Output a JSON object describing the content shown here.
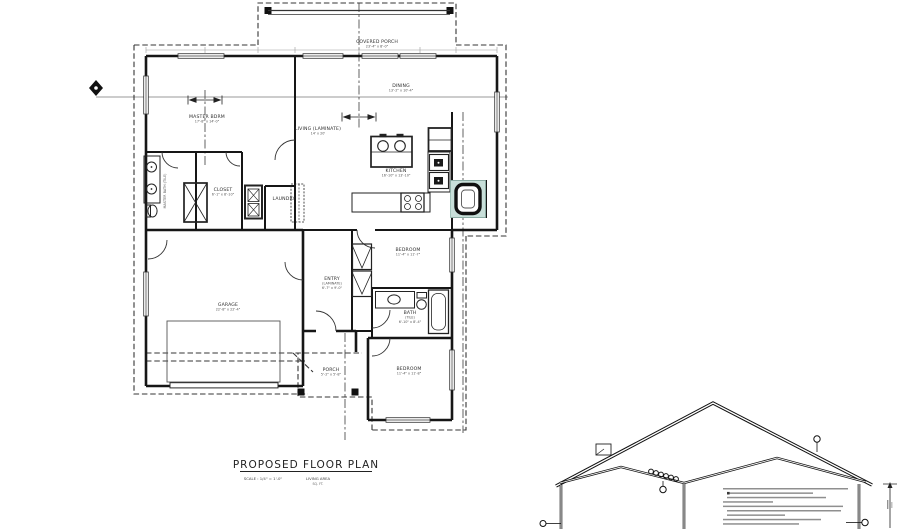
{
  "title_block": {
    "heading": "PROPOSED FLOOR PLAN",
    "scale": "SCALE : 1/4\" = 1'-0\"",
    "area_label": "LIVING AREA",
    "area_sub": "SQ. FT."
  },
  "rooms": {
    "covered_porch": {
      "name": "COVERED PORCH",
      "dims": "23'-4\" x 8'-0\""
    },
    "dining": {
      "name": "DINING",
      "dims": "13'-2\" x 10'-4\""
    },
    "master_bdrm": {
      "name": "MASTER BDRM",
      "dims": "17'-8\" x 14'-0\""
    },
    "living": {
      "name": "LIVING (LAMINATE)",
      "dims": "14' x 20'"
    },
    "kitchen": {
      "name": "KITCHEN",
      "dims": "16'-10\" x 13'-10\""
    },
    "master_bath": {
      "name": "MASTER BATH (TILE)"
    },
    "closet": {
      "name": "CLOSET",
      "dims": "6'-1\" x 8'-10\""
    },
    "laundry": {
      "name": "LAUNDRY"
    },
    "entry": {
      "name": "ENTRY",
      "sub": "(LAMINATE)",
      "dims": "6'-7\" x 9'-0\""
    },
    "garage": {
      "name": "GARAGE",
      "dims": "22'-8\" x 22'-4\""
    },
    "bedroom1": {
      "name": "BEDROOM",
      "dims": "11'-4\" x 11'-7\""
    },
    "bath2": {
      "name": "BATH",
      "sub": "(TILE)",
      "dims": "6'-10\" x 8'-4\""
    },
    "porch": {
      "name": "PORCH",
      "dims": "5'-2\" x 5'-8\""
    },
    "bedroom2": {
      "name": "BEDROOM",
      "dims": "11'-4\" x 11'-8\""
    }
  },
  "colors": {
    "wall": "#161616",
    "dashed_overhang": "#353535",
    "section_line": "#999999",
    "highlight_fill": "#c8dfd9",
    "highlight_edge": "#93b8ae",
    "dim_text": "#555555"
  }
}
